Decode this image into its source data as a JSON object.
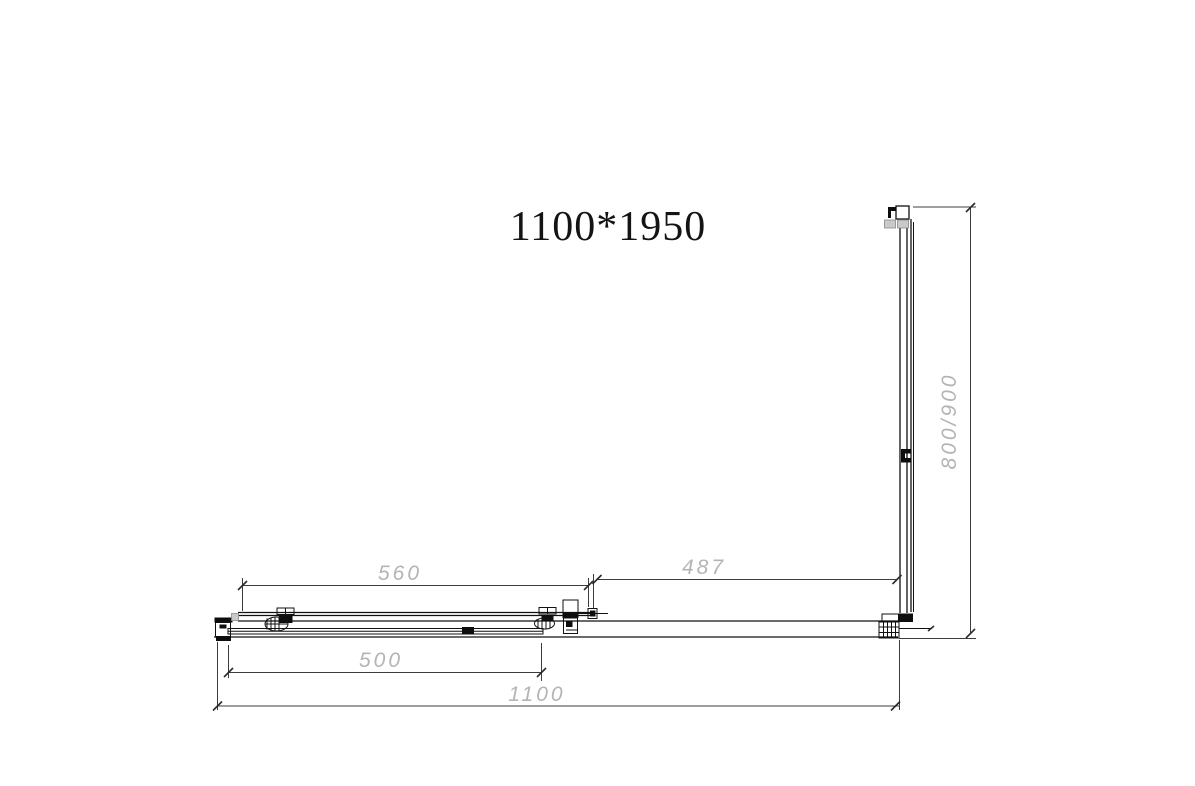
{
  "title": "1100*1950",
  "dimensions": {
    "fixed_panel_width": "560",
    "door_opening_width": "487",
    "sliding_door_width": "500",
    "total_width": "1100",
    "side_panel_depth": "800/900"
  },
  "colors": {
    "object_line": "#111111",
    "dimension_line": "#3d3d3d",
    "dimension_text": "#b4b4b4",
    "background": "#ffffff"
  }
}
